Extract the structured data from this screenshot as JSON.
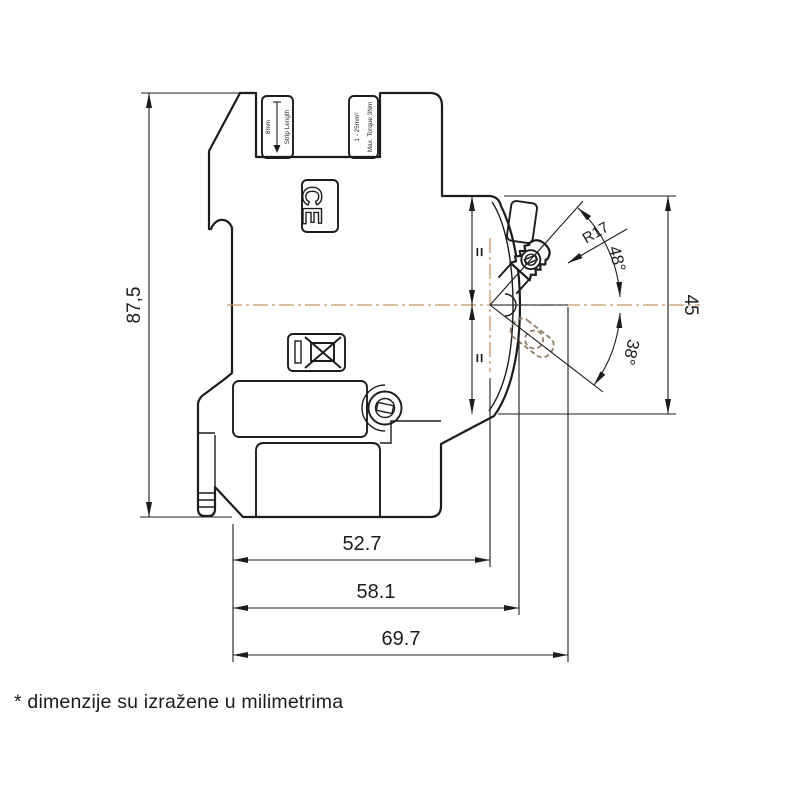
{
  "drawing": {
    "note": "* dimenzije su izražene u milimetrima",
    "dimensions": {
      "overall_height": "87,5",
      "front_face_height": "45",
      "depth_to_toggle_axis": "52.7",
      "depth_to_front_face": "58.1",
      "overall_depth": "69.7",
      "toggle_on_angle": "48°",
      "toggle_off_angle": "38°",
      "toggle_radius": "R17",
      "equal_segment_mark": "="
    },
    "device_markings": {
      "strip_length_label": "Strip Length",
      "strip_length_value": "8mm",
      "max_torque_label": "Max. Torque 3Nm",
      "wire_range_label": "1 - 25mm²",
      "ce_mark": "CE"
    },
    "colors": {
      "line": "#1C1C1C",
      "centerline": "#C49668",
      "hidden_state": "#8F7F6B",
      "background": "#FFFFFF"
    }
  }
}
